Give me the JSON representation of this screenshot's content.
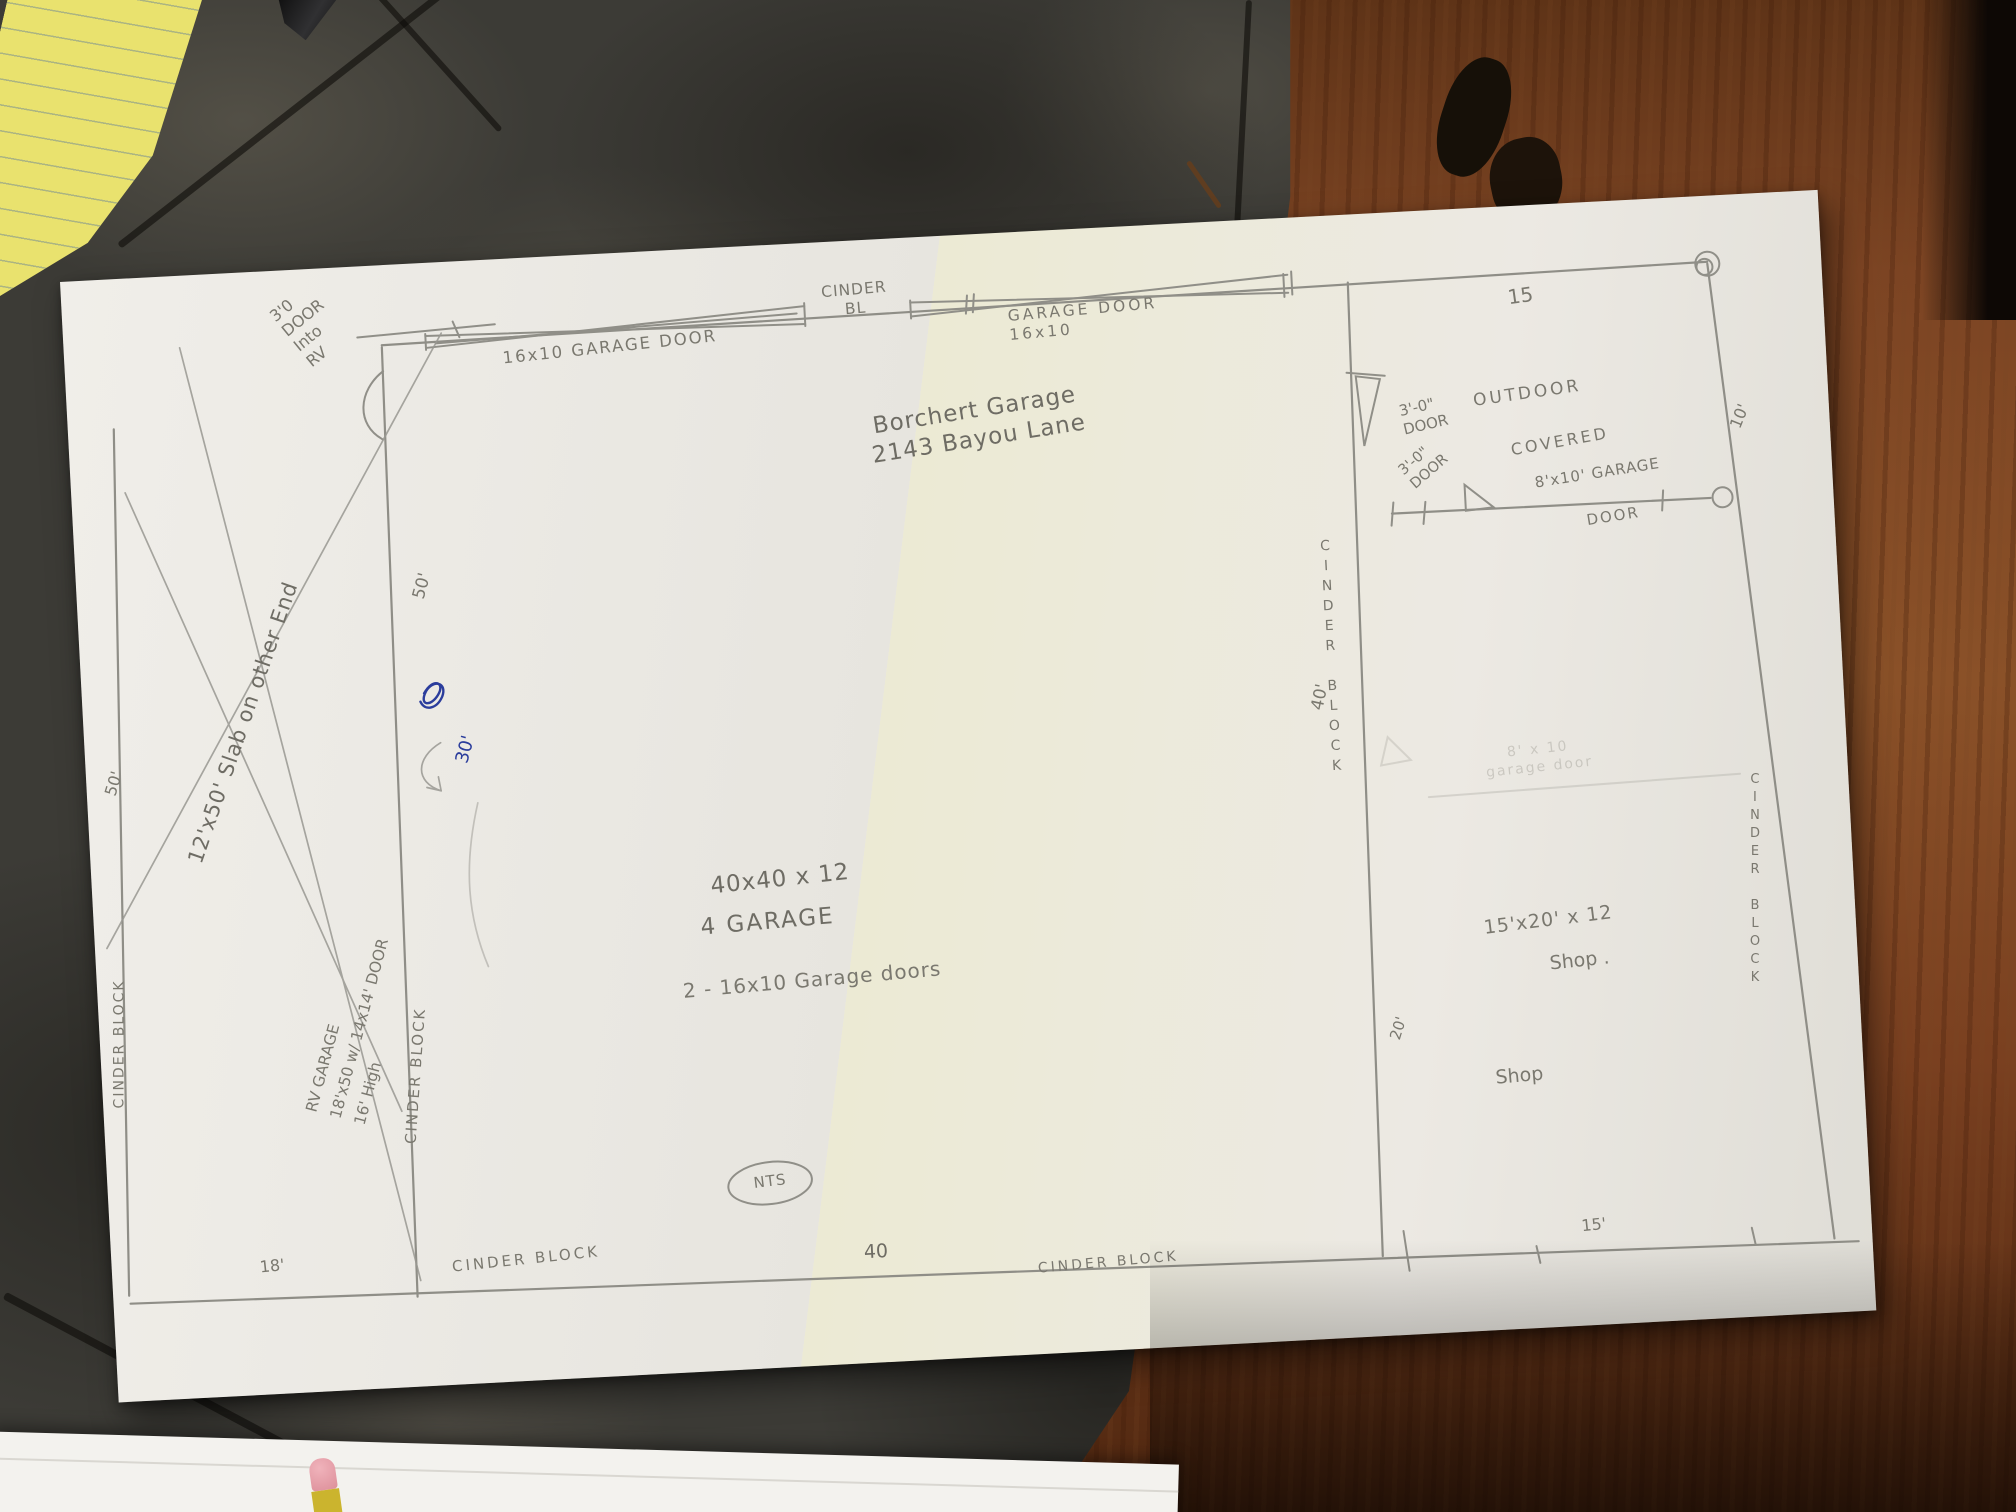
{
  "plan": {
    "title": "Borchert Garage\n2143 Bayou Lane",
    "scale_note": "NTS",
    "buildings": {
      "main_garage": {
        "dimensions": "40x40 x 12",
        "name": "4 GARAGE",
        "doors_note": "2 - 16x10 Garage doors"
      },
      "rv_garage": {
        "name_block": "RV GARAGE\n18'x50 w/ 14x14' DOOR\n16' High",
        "slab_note": "12'x50' Slab on other End",
        "entry_note": "3'0\nDOOR\nInto\nRV"
      },
      "shop": {
        "dimensions": "15'x20' x 12",
        "name": "Shop .",
        "name_2": "Shop"
      },
      "outdoor": {
        "line1": "OUTDOOR",
        "line2": "COVERED"
      }
    },
    "doors": {
      "top_left_garage_door": "16x10 GARAGE DOOR",
      "top_right_garage_door": "GARAGE DOOR\n16x10",
      "entry_door_top": "3'-0\"\nDOOR",
      "entry_door_mid": "3'-0\"\nDOOR",
      "rear_garage_door": "8'x10' GARAGE",
      "rear_garage_door_2": "DOOR",
      "erased_door_note": "8' x 10\ngarage door"
    },
    "walls": {
      "cinder_top": "CINDER\nBL",
      "cinder_left_outer": "CINDER BLOCK",
      "cinder_left_inner": "CINDER BLOCK",
      "cinder_mid_vertical": "CINDER BLOCK",
      "cinder_right_vertical": "CINDER BLOCK",
      "cinder_bottom_left": "CINDER BLOCK",
      "cinder_bottom_right": "CINDER BLOCK"
    },
    "dimensions": {
      "top_15": "15",
      "right_10": "10'",
      "left_50": "50'",
      "mid_50": "50'",
      "blue_30": "30'",
      "right_40": "40'",
      "shop_20": "20'",
      "bottom_40": "40",
      "bottom_18": "18'",
      "bottom_15": "15'"
    }
  },
  "colors": {
    "pencil": "#8f8e87",
    "ink_blue": "#2b3d9c",
    "paper": "#eae8e2",
    "slate": "#3c3b36",
    "wood": "#8a5128",
    "notepad_yellow": "#e9e26e"
  }
}
